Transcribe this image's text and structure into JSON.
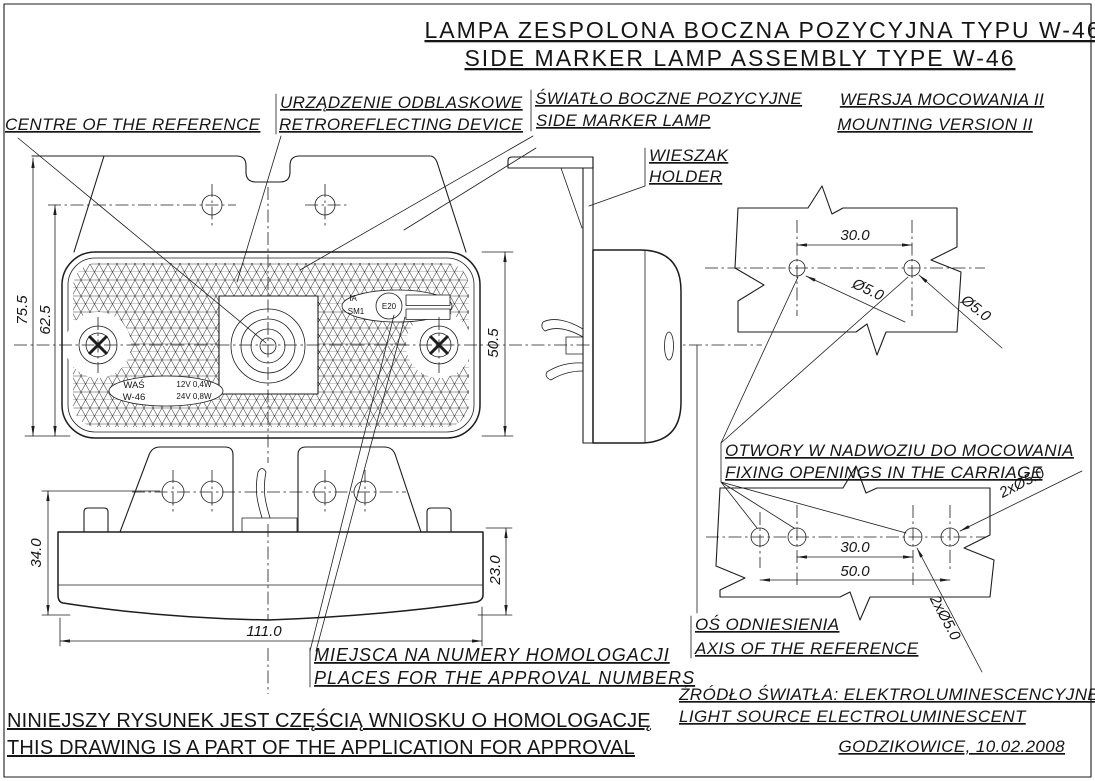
{
  "title": {
    "pl": "LAMPA ZESPOLONA BOCZNA POZYCYJNA TYPU W-46",
    "en": "SIDE MARKER LAMP ASSEMBLY TYPE W-46"
  },
  "labels": {
    "centre_reference": "CENTRE OF THE REFERENCE",
    "retroreflector_pl": "URZĄDZENIE ODBLASKOWE",
    "retroreflector_en": "RETROREFLECTING DEVICE",
    "side_marker_pl": "ŚWIATŁO BOCZNE POZYCYJNE",
    "side_marker_en": "SIDE MARKER LAMP",
    "mounting_version_pl": "WERSJA MOCOWANIA II",
    "mounting_version_en": "MOUNTING VERSION II",
    "holder_pl": "WIESZAK",
    "holder_en": "HOLDER",
    "fixing_openings_pl": "OTWORY W NADWOZIU DO MOCOWANIA",
    "fixing_openings_en": "FIXING OPENINGS IN THE CARRIAGE",
    "axis_reference_pl": "OŚ ODNIESIENIA",
    "axis_reference_en": "AXIS OF THE REFERENCE",
    "approval_numbers_pl": "MIEJSCA NA NUMERY HOMOLOGACJI",
    "approval_numbers_en": "PLACES FOR THE APPROVAL NUMBERS",
    "light_source_pl": "ŹRÓDŁO ŚWIATŁA: ELEKTROLUMINESCENCYJNE",
    "light_source_en": "LIGHT SOURCE ELECTROLUMINESCENT",
    "place_date": "GODZIKOWICE, 10.02.2008"
  },
  "footer": {
    "pl": "NINIEJSZY RYSUNEK JEST CZĘŚCIĄ WNIOSKU O HOMOLOGACJĘ",
    "en": "THIS DRAWING IS A PART OF THE APPLICATION FOR APPROVAL"
  },
  "dimensions": {
    "front_overall_height": "75.5",
    "front_body_height": "62.5",
    "front_lens_height": "50.5",
    "bottom_overall_height": "34.0",
    "bottom_lens_height": "23.0",
    "bottom_width": "111.0",
    "top_plate_hole_spacing": "30.0",
    "top_plate_hole_dia_1": "Ø5.0",
    "top_plate_hole_dia_2": "Ø5.0",
    "bottom_plate_inner_spacing": "30.0",
    "bottom_plate_outer_spacing": "50.0",
    "bottom_plate_holes_1": "2xØ5.0",
    "bottom_plate_holes_2": "2xØ5.0"
  },
  "markings": {
    "brand": "WAŚ",
    "model": "W-46",
    "power_12v": "12V 0,4W",
    "power_24v": "24V 0,8W",
    "category_1": "IA",
    "category_2": "SM1",
    "e_mark": "E20"
  }
}
